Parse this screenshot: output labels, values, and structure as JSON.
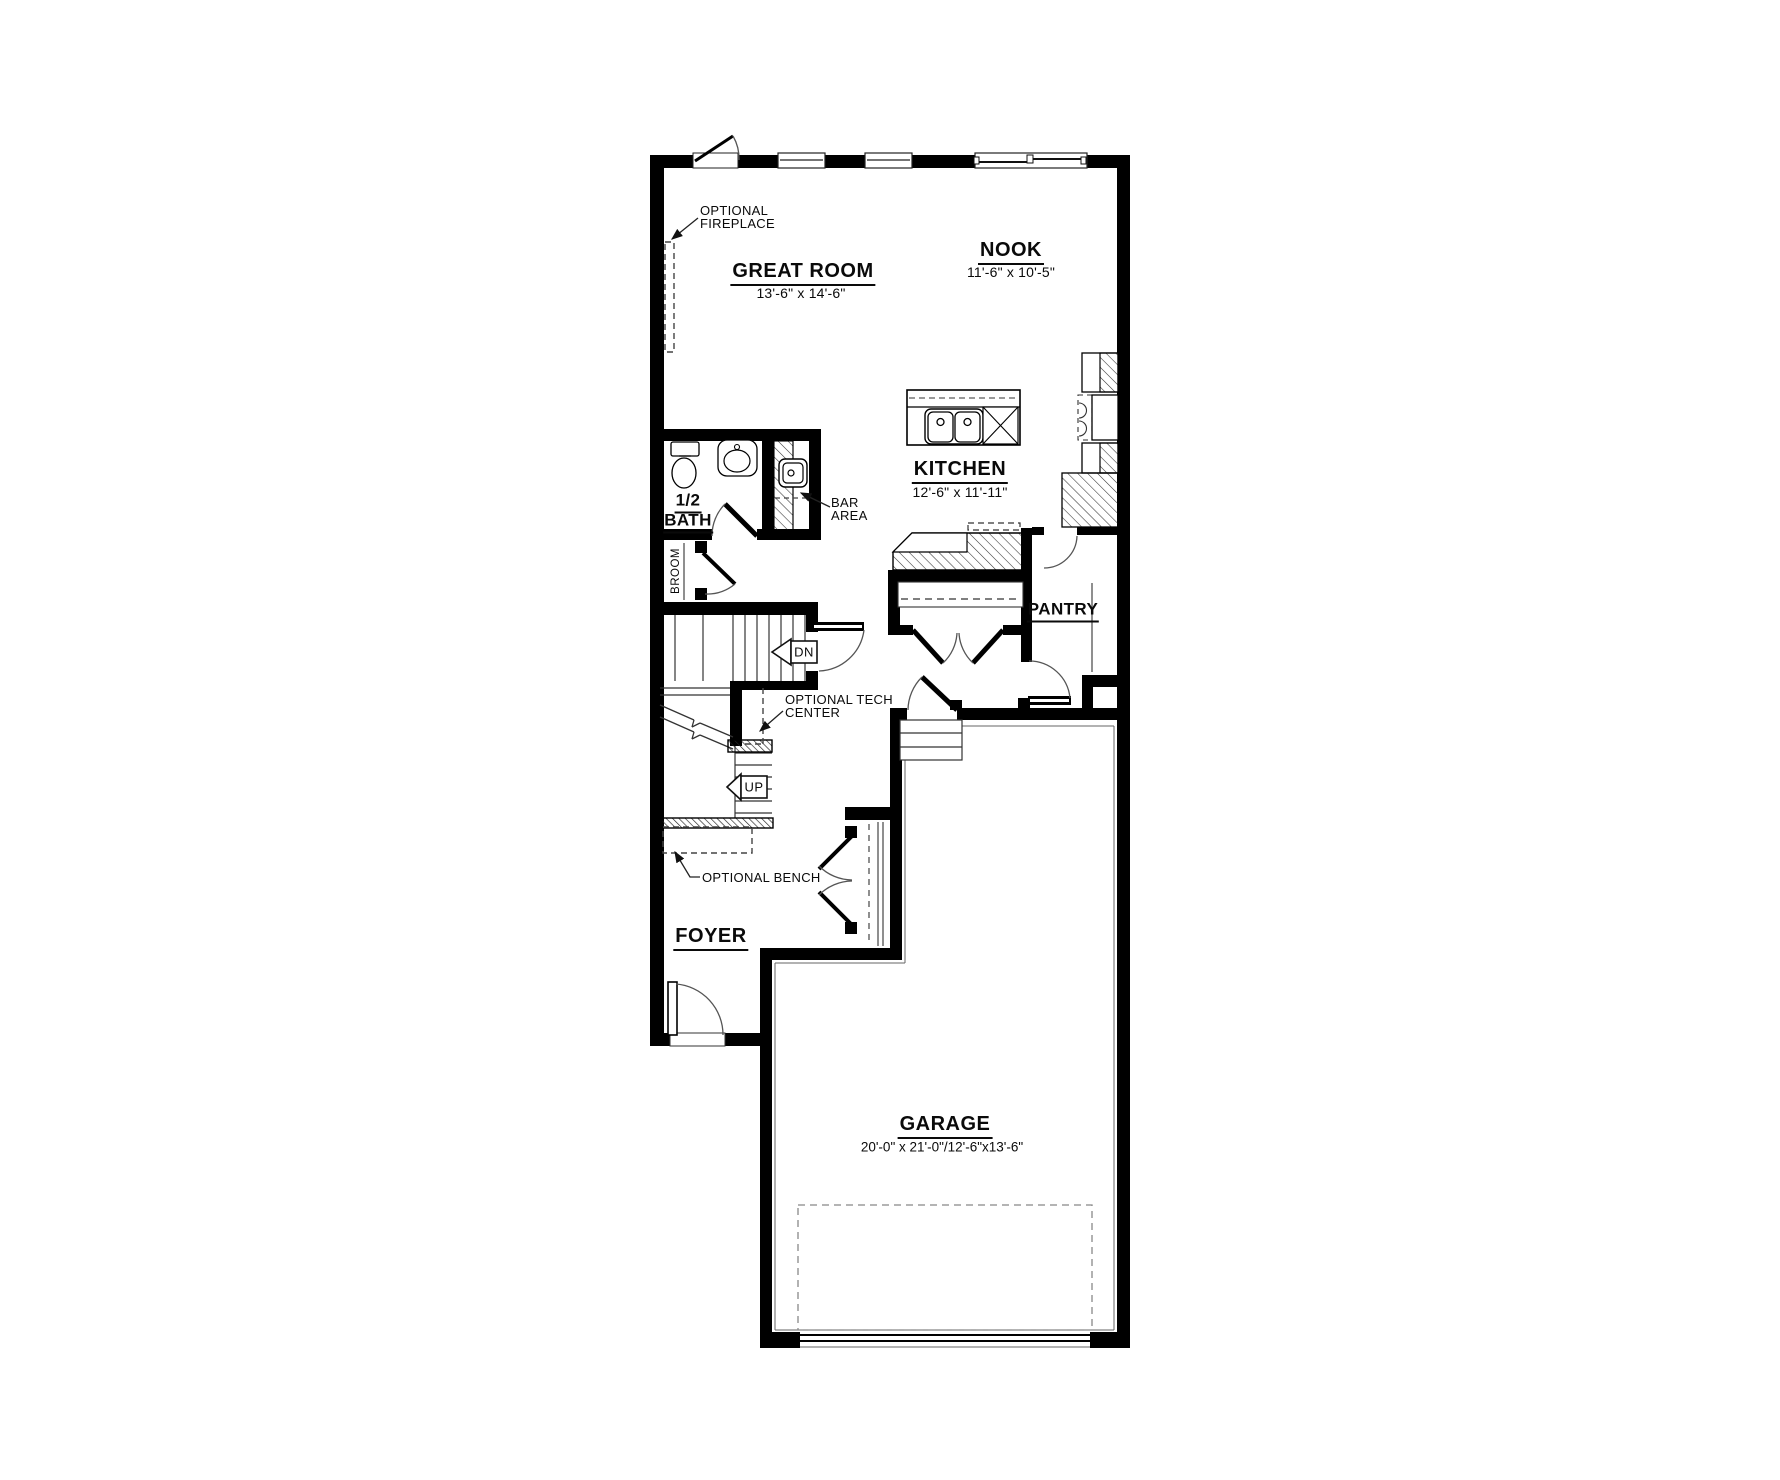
{
  "plan": {
    "rooms": {
      "great_room": {
        "name": "GREAT ROOM",
        "dims": "13'-6\" x 14'-6\""
      },
      "nook": {
        "name": "NOOK",
        "dims": "11'-6\" x 10'-5\""
      },
      "kitchen": {
        "name": "KITCHEN",
        "dims": "12'-6\" x 11'-11\""
      },
      "pantry": {
        "name": "PANTRY"
      },
      "half_bath": {
        "name_line1": "1/2",
        "name_line2": "BATH"
      },
      "broom": {
        "name": "BROOM"
      },
      "foyer": {
        "name": "FOYER"
      },
      "garage": {
        "name": "GARAGE",
        "dims": "20'-0\" x 21'-0\"/12'-6\"x13'-6\""
      }
    },
    "annotations": {
      "optional_fireplace": {
        "line1": "OPTIONAL",
        "line2": "FIREPLACE"
      },
      "bar_area": {
        "line1": "BAR",
        "line2": "AREA"
      },
      "optional_tech_center": {
        "line1": "OPTIONAL TECH",
        "line2": "CENTER"
      },
      "optional_bench": {
        "label": "OPTIONAL BENCH"
      }
    },
    "stairs": {
      "down_label": "DN",
      "up_label": "UP"
    },
    "colors": {
      "wall": "#000000",
      "background": "#ffffff",
      "thin_line": "#2a2a2a"
    }
  }
}
